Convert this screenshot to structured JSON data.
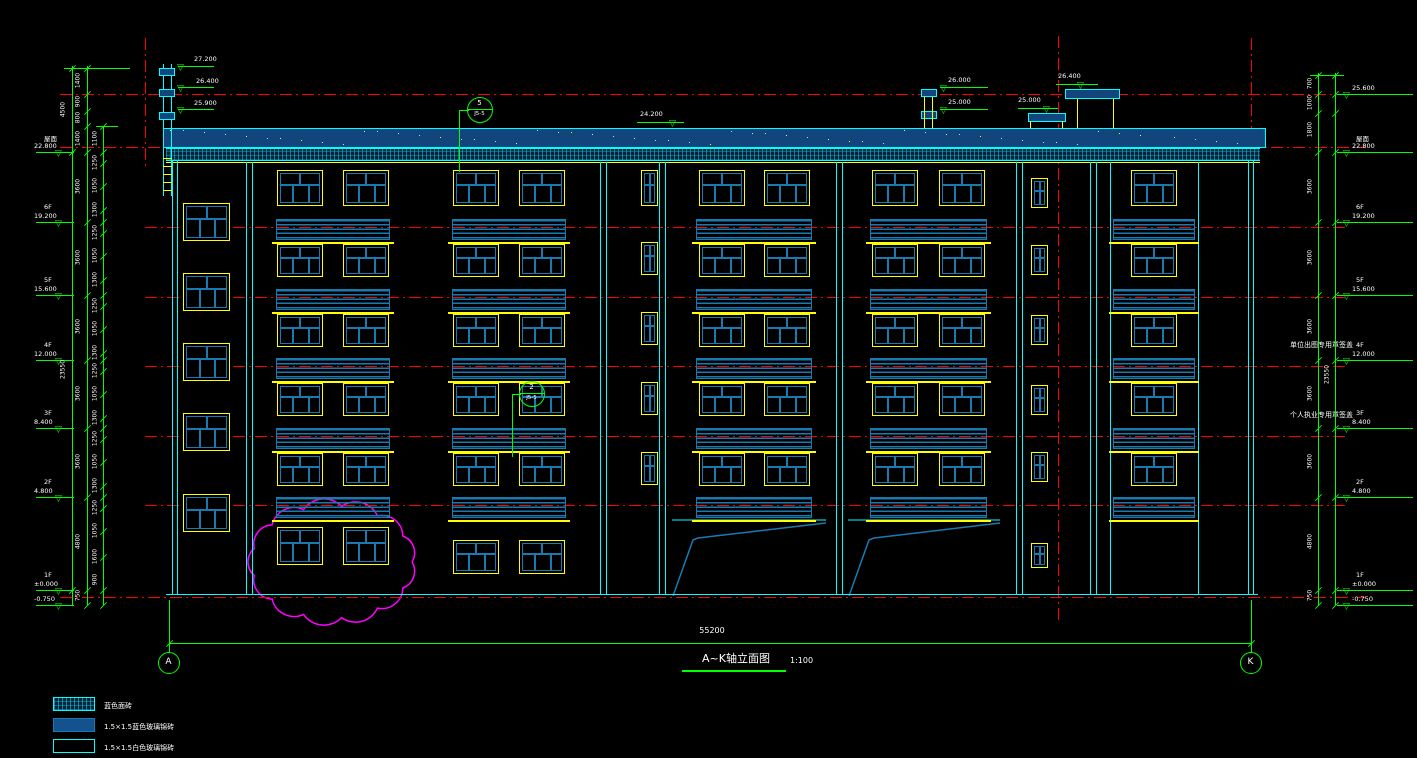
{
  "title": {
    "text": "A~K轴立面图",
    "scale": "1:100"
  },
  "overall_dimension": "55200",
  "axis_bubbles": {
    "left": "A",
    "right": "K"
  },
  "levels_left": [
    {
      "label": "屋面",
      "value": "22.800"
    },
    {
      "label": "6F",
      "value": "19.200"
    },
    {
      "label": "5F",
      "value": "15.600"
    },
    {
      "label": "4F",
      "value": "12.000"
    },
    {
      "label": "3F",
      "value": "8.400"
    },
    {
      "label": "2F",
      "value": "4.800"
    },
    {
      "label": "1F",
      "value": "±0.000"
    },
    {
      "label": "",
      "value": "-0.750"
    }
  ],
  "levels_right": [
    {
      "label": "",
      "value": "25.600"
    },
    {
      "label": "屋面",
      "value": "22.800"
    },
    {
      "label": "6F",
      "value": "19.200"
    },
    {
      "label": "5F",
      "value": "15.600"
    },
    {
      "label": "4F",
      "value": "12.000"
    },
    {
      "label": "3F",
      "value": "8.400"
    },
    {
      "label": "2F",
      "value": "4.800"
    },
    {
      "label": "1F",
      "value": "±0.000"
    },
    {
      "label": "",
      "value": "-0.750"
    }
  ],
  "roof_elevations": [
    {
      "value": "27.200"
    },
    {
      "value": "26.400"
    },
    {
      "value": "25.900"
    },
    {
      "value": "24.200"
    },
    {
      "value": "26.000"
    },
    {
      "value": "25.000"
    },
    {
      "value": "25.000"
    },
    {
      "value": "26.400"
    }
  ],
  "detail_callouts": [
    {
      "number": "5",
      "sheet": "J5-5"
    },
    {
      "number": "2",
      "sheet": "J5-5"
    }
  ],
  "dimensions": {
    "left_outer": [
      "4500",
      "23550"
    ],
    "left_floor_chain": [
      "1400",
      "900",
      "800",
      "1400",
      "3600",
      "3600",
      "3600",
      "3600",
      "3600",
      "4800",
      "750"
    ],
    "left_window_chain": [
      "1100",
      "1250",
      "1050",
      "1300",
      "1250",
      "1050",
      "1300",
      "1250",
      "1050",
      "1300",
      "1250",
      "1050",
      "1300",
      "1250",
      "1050",
      "1300",
      "1250",
      "1050",
      "1600",
      "900"
    ],
    "right_outer": [
      "23550"
    ],
    "right_floor_chain": [
      "700",
      "1000",
      "1800",
      "3600",
      "3600",
      "3600",
      "3600",
      "3600",
      "4800",
      "750"
    ]
  },
  "legend": [
    {
      "swatch": "hatch",
      "label": "蓝色面砖"
    },
    {
      "swatch": "solid",
      "label": "1.5×1.5蓝色玻璃锦砖"
    },
    {
      "swatch": "outline",
      "label": "1.5×1.5白色玻璃锦砖"
    }
  ],
  "stamps": [
    "单位出图专用章签盖",
    "个人执业专用章签盖"
  ],
  "icons": {
    "level_marker": "▽"
  },
  "colors": {
    "line_cyan": "#00ffff",
    "line_green": "#00ff00",
    "line_red": "#ff0000",
    "line_yellow": "#ffff00",
    "line_magenta": "#ff00ff",
    "fill_blue": "#11457c",
    "mullion_blue": "#1a7ab0",
    "text_white": "#ffffff"
  }
}
